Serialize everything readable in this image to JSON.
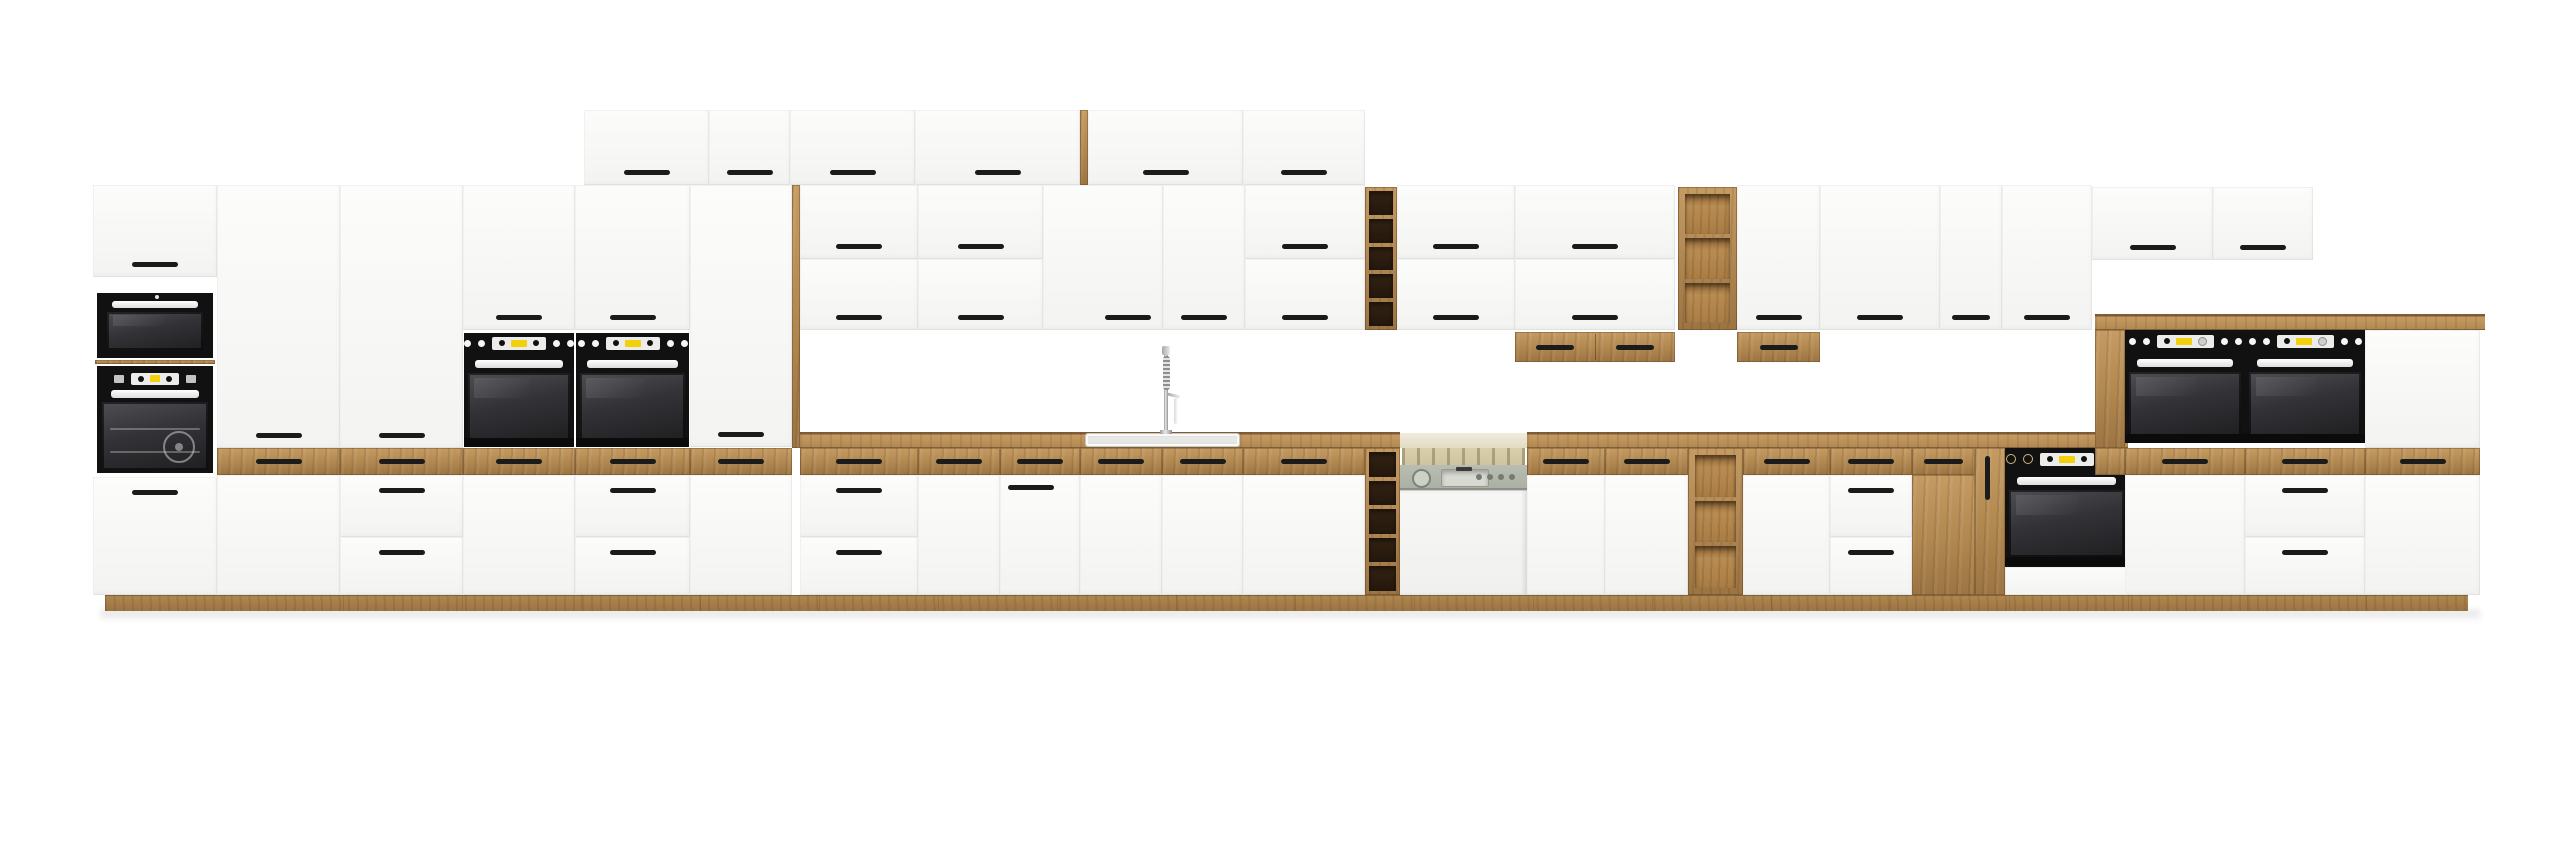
{
  "palette": {
    "bg": "#ffffff",
    "white_hi": "#fcfcfb",
    "white_lo": "#f3f3f1",
    "wood_light": "#c59b63",
    "wood_mid": "#b0874f",
    "wood_dark": "#9c7443",
    "wood_edge": "#7e5c38",
    "handle": "#1b1b1b",
    "appliance_black": "#0d0d0d",
    "glass_hi": "#4e4e53",
    "glass_mid": "#333337",
    "glass_lo": "#1f1f22",
    "display_yellow": "#f2d10c",
    "display_silver": "#ececea",
    "knob_white": "#f5f5f5",
    "knob_gold": "#cdb57c",
    "dw_panel": "#b9bdb2",
    "dw_interior": "#d9d0ac"
  },
  "scene": {
    "width": 2560,
    "height": 848,
    "floor_shadow": {
      "x": 100,
      "y": 610,
      "w": 2380,
      "h": 12
    },
    "plinth": {
      "x": 105,
      "y": 595,
      "w": 2363,
      "h": 16
    },
    "counters": [
      {
        "x": 800,
        "y": 432,
        "w": 600,
        "h": 16
      },
      {
        "x": 1527,
        "y": 432,
        "w": 601,
        "h": 16
      }
    ],
    "sideboard_top": {
      "x": 2095,
      "y": 314,
      "w": 390,
      "h": 16
    },
    "units": [
      {
        "t": "door",
        "x": 584,
        "y": 110,
        "w": 125,
        "h": 75,
        "hd": "bc"
      },
      {
        "t": "door",
        "x": 709,
        "y": 110,
        "w": 81,
        "h": 75,
        "hd": "bc"
      },
      {
        "t": "door",
        "x": 790,
        "y": 110,
        "w": 125,
        "h": 75,
        "hd": "bc"
      },
      {
        "t": "door",
        "x": 915,
        "y": 110,
        "w": 165,
        "h": 75,
        "hd": "bc"
      },
      {
        "t": "panel",
        "x": 1080,
        "y": 110,
        "w": 8,
        "h": 75
      },
      {
        "t": "door",
        "x": 1088,
        "y": 110,
        "w": 155,
        "h": 75,
        "hd": "bc"
      },
      {
        "t": "door",
        "x": 1243,
        "y": 110,
        "w": 122,
        "h": 75,
        "hd": "bc"
      },
      {
        "t": "door",
        "x": 93,
        "y": 185,
        "w": 124,
        "h": 92,
        "hd": "bc"
      },
      {
        "t": "micro",
        "x": 97,
        "y": 293,
        "w": 116,
        "h": 65
      },
      {
        "t": "panel",
        "x": 95,
        "y": 360,
        "w": 120,
        "h": 4
      },
      {
        "t": "toven",
        "x": 97,
        "y": 366,
        "w": 116,
        "h": 107
      },
      {
        "t": "door",
        "x": 93,
        "y": 477,
        "w": 124,
        "h": 118,
        "hd": "tc"
      },
      {
        "t": "door",
        "x": 217,
        "y": 185,
        "w": 123,
        "h": 263,
        "hd": "bc"
      },
      {
        "t": "wood",
        "x": 217,
        "y": 448,
        "w": 123,
        "h": 27,
        "hd": "c"
      },
      {
        "t": "door",
        "x": 217,
        "y": 475,
        "w": 123,
        "h": 120
      },
      {
        "t": "door",
        "x": 340,
        "y": 185,
        "w": 123,
        "h": 263,
        "hd": "bc"
      },
      {
        "t": "wood",
        "x": 340,
        "y": 448,
        "w": 123,
        "h": 27,
        "hd": "c"
      },
      {
        "t": "door",
        "x": 340,
        "y": 475,
        "w": 123,
        "h": 62,
        "hd": "tc"
      },
      {
        "t": "door",
        "x": 340,
        "y": 537,
        "w": 123,
        "h": 58,
        "hd": "tc"
      },
      {
        "t": "door",
        "x": 463,
        "y": 185,
        "w": 112,
        "h": 145,
        "hd": "bc"
      },
      {
        "t": "oven",
        "x": 464,
        "y": 333,
        "w": 110,
        "h": 114,
        "v": "mid"
      },
      {
        "t": "wood",
        "x": 463,
        "y": 448,
        "w": 112,
        "h": 27,
        "hd": "c"
      },
      {
        "t": "door",
        "x": 463,
        "y": 475,
        "w": 112,
        "h": 120
      },
      {
        "t": "door",
        "x": 575,
        "y": 185,
        "w": 115,
        "h": 145,
        "hd": "bc"
      },
      {
        "t": "oven",
        "x": 576,
        "y": 333,
        "w": 113,
        "h": 114,
        "v": "mid"
      },
      {
        "t": "wood",
        "x": 575,
        "y": 448,
        "w": 115,
        "h": 27,
        "hd": "c"
      },
      {
        "t": "door",
        "x": 575,
        "y": 475,
        "w": 115,
        "h": 62,
        "hd": "tc"
      },
      {
        "t": "door",
        "x": 575,
        "y": 537,
        "w": 115,
        "h": 58,
        "hd": "tc"
      },
      {
        "t": "door",
        "x": 690,
        "y": 185,
        "w": 102,
        "h": 262,
        "hd": "bc"
      },
      {
        "t": "wood",
        "x": 690,
        "y": 448,
        "w": 102,
        "h": 27,
        "hd": "c"
      },
      {
        "t": "door",
        "x": 690,
        "y": 475,
        "w": 102,
        "h": 120
      },
      {
        "t": "panel",
        "x": 792,
        "y": 185,
        "w": 8,
        "h": 263
      },
      {
        "t": "door",
        "x": 800,
        "y": 185,
        "w": 118,
        "h": 74,
        "hd": "bc"
      },
      {
        "t": "door",
        "x": 800,
        "y": 259,
        "w": 118,
        "h": 71,
        "hd": "bc"
      },
      {
        "t": "door",
        "x": 918,
        "y": 185,
        "w": 125,
        "h": 74,
        "hd": "bc"
      },
      {
        "t": "door",
        "x": 918,
        "y": 259,
        "w": 125,
        "h": 71,
        "hd": "bc"
      },
      {
        "t": "door",
        "x": 1043,
        "y": 185,
        "w": 120,
        "h": 145,
        "hd": "br"
      },
      {
        "t": "door",
        "x": 1163,
        "y": 185,
        "w": 82,
        "h": 145,
        "hd": "bc"
      },
      {
        "t": "door",
        "x": 1245,
        "y": 185,
        "w": 120,
        "h": 74,
        "hd": "bc"
      },
      {
        "t": "door",
        "x": 1245,
        "y": 259,
        "w": 120,
        "h": 71,
        "hd": "bc"
      },
      {
        "t": "shelf",
        "x": 1365,
        "y": 187,
        "w": 32,
        "h": 143,
        "n": 5,
        "int": "dark"
      },
      {
        "t": "door",
        "x": 1397,
        "y": 185,
        "w": 118,
        "h": 74,
        "hd": "bc"
      },
      {
        "t": "door",
        "x": 1397,
        "y": 259,
        "w": 118,
        "h": 71,
        "hd": "bc"
      },
      {
        "t": "door",
        "x": 1515,
        "y": 185,
        "w": 160,
        "h": 74,
        "hd": "bc"
      },
      {
        "t": "door",
        "x": 1515,
        "y": 259,
        "w": 160,
        "h": 71,
        "hd": "bc"
      },
      {
        "t": "box",
        "x": 1515,
        "y": 332,
        "w": 160,
        "h": 30,
        "n": 2
      },
      {
        "t": "shelf",
        "x": 1678,
        "y": 187,
        "w": 59,
        "h": 143,
        "n": 3,
        "int": "light"
      },
      {
        "t": "door",
        "x": 1737,
        "y": 185,
        "w": 83,
        "h": 145,
        "hd": "bc"
      },
      {
        "t": "box",
        "x": 1737,
        "y": 332,
        "w": 83,
        "h": 30,
        "n": 1
      },
      {
        "t": "door",
        "x": 1820,
        "y": 185,
        "w": 120,
        "h": 145,
        "hd": "bc"
      },
      {
        "t": "door",
        "x": 1940,
        "y": 185,
        "w": 62,
        "h": 145,
        "hd": "bc"
      },
      {
        "t": "door",
        "x": 2002,
        "y": 185,
        "w": 90,
        "h": 145,
        "hd": "bc"
      },
      {
        "t": "door",
        "x": 2092,
        "y": 187,
        "w": 121,
        "h": 73,
        "hd": "bc"
      },
      {
        "t": "door",
        "x": 2213,
        "y": 187,
        "w": 100,
        "h": 73,
        "hd": "bc"
      },
      {
        "t": "wood",
        "x": 800,
        "y": 448,
        "w": 118,
        "h": 27,
        "hd": "c"
      },
      {
        "t": "door",
        "x": 800,
        "y": 475,
        "w": 118,
        "h": 62,
        "hd": "tc"
      },
      {
        "t": "door",
        "x": 800,
        "y": 537,
        "w": 118,
        "h": 58,
        "hd": "tc"
      },
      {
        "t": "wood",
        "x": 918,
        "y": 448,
        "w": 82,
        "h": 27,
        "hd": "c"
      },
      {
        "t": "door",
        "x": 918,
        "y": 475,
        "w": 82,
        "h": 120
      },
      {
        "t": "wood",
        "x": 1000,
        "y": 448,
        "w": 80,
        "h": 27,
        "hd": "c"
      },
      {
        "t": "door",
        "x": 1000,
        "y": 475,
        "w": 80,
        "h": 120,
        "hd": "tl"
      },
      {
        "t": "wood",
        "x": 1080,
        "y": 448,
        "w": 82,
        "h": 27,
        "hd": "c"
      },
      {
        "t": "door",
        "x": 1080,
        "y": 475,
        "w": 82,
        "h": 120
      },
      {
        "t": "wood",
        "x": 1162,
        "y": 448,
        "w": 81,
        "h": 27,
        "hd": "c"
      },
      {
        "t": "door",
        "x": 1162,
        "y": 475,
        "w": 81,
        "h": 120
      },
      {
        "t": "wood",
        "x": 1243,
        "y": 448,
        "w": 122,
        "h": 27,
        "hd": "c"
      },
      {
        "t": "door",
        "x": 1243,
        "y": 475,
        "w": 122,
        "h": 120
      },
      {
        "t": "shelf",
        "x": 1365,
        "y": 448,
        "w": 35,
        "h": 147,
        "n": 5,
        "int": "dark"
      },
      {
        "t": "dw",
        "x": 1400,
        "y": 433,
        "w": 127,
        "h": 162
      },
      {
        "t": "wood",
        "x": 1527,
        "y": 448,
        "w": 78,
        "h": 27,
        "hd": "c"
      },
      {
        "t": "door",
        "x": 1527,
        "y": 475,
        "w": 78,
        "h": 120
      },
      {
        "t": "wood",
        "x": 1605,
        "y": 448,
        "w": 83,
        "h": 27,
        "hd": "c"
      },
      {
        "t": "door",
        "x": 1605,
        "y": 475,
        "w": 83,
        "h": 120
      },
      {
        "t": "shelf",
        "x": 1688,
        "y": 448,
        "w": 55,
        "h": 147,
        "n": 3,
        "int": "light"
      },
      {
        "t": "wood",
        "x": 1743,
        "y": 448,
        "w": 87,
        "h": 27,
        "hd": "c"
      },
      {
        "t": "door",
        "x": 1743,
        "y": 475,
        "w": 87,
        "h": 120
      },
      {
        "t": "wood",
        "x": 1830,
        "y": 448,
        "w": 82,
        "h": 27,
        "hd": "c"
      },
      {
        "t": "door",
        "x": 1830,
        "y": 475,
        "w": 82,
        "h": 62,
        "hd": "tc"
      },
      {
        "t": "door",
        "x": 1830,
        "y": 537,
        "w": 82,
        "h": 58,
        "hd": "tc"
      },
      {
        "t": "wood",
        "x": 1912,
        "y": 448,
        "w": 63,
        "h": 27,
        "hd": "c"
      },
      {
        "t": "wood",
        "x": 1912,
        "y": 475,
        "w": 63,
        "h": 120
      },
      {
        "t": "wood",
        "x": 1975,
        "y": 448,
        "w": 30,
        "h": 147,
        "hd": "v"
      },
      {
        "t": "oven",
        "x": 2005,
        "y": 448,
        "w": 123,
        "h": 147,
        "v": "under"
      },
      {
        "t": "panel",
        "x": 2095,
        "y": 330,
        "w": 30,
        "h": 118
      },
      {
        "t": "oven",
        "x": 2125,
        "y": 330,
        "w": 120,
        "h": 113,
        "v": "side"
      },
      {
        "t": "oven",
        "x": 2245,
        "y": 330,
        "w": 120,
        "h": 113,
        "v": "side"
      },
      {
        "t": "door",
        "x": 2365,
        "y": 330,
        "w": 115,
        "h": 118
      },
      {
        "t": "wood",
        "x": 2095,
        "y": 448,
        "w": 30,
        "h": 27
      },
      {
        "t": "wood",
        "x": 2125,
        "y": 448,
        "w": 120,
        "h": 27,
        "hd": "c"
      },
      {
        "t": "wood",
        "x": 2245,
        "y": 448,
        "w": 120,
        "h": 27,
        "hd": "c"
      },
      {
        "t": "wood",
        "x": 2365,
        "y": 448,
        "w": 115,
        "h": 27,
        "hd": "c"
      },
      {
        "t": "door",
        "x": 2125,
        "y": 475,
        "w": 120,
        "h": 120
      },
      {
        "t": "door",
        "x": 2245,
        "y": 475,
        "w": 120,
        "h": 62,
        "hd": "tc"
      },
      {
        "t": "door",
        "x": 2245,
        "y": 537,
        "w": 120,
        "h": 58,
        "hd": "tc"
      },
      {
        "t": "door",
        "x": 2365,
        "y": 475,
        "w": 115,
        "h": 120
      },
      {
        "t": "sink",
        "x": 1085,
        "y": 433,
        "w": 155,
        "h": 14
      },
      {
        "t": "faucet",
        "x": 1146,
        "y": 346,
        "w": 40,
        "h": 88
      }
    ]
  }
}
